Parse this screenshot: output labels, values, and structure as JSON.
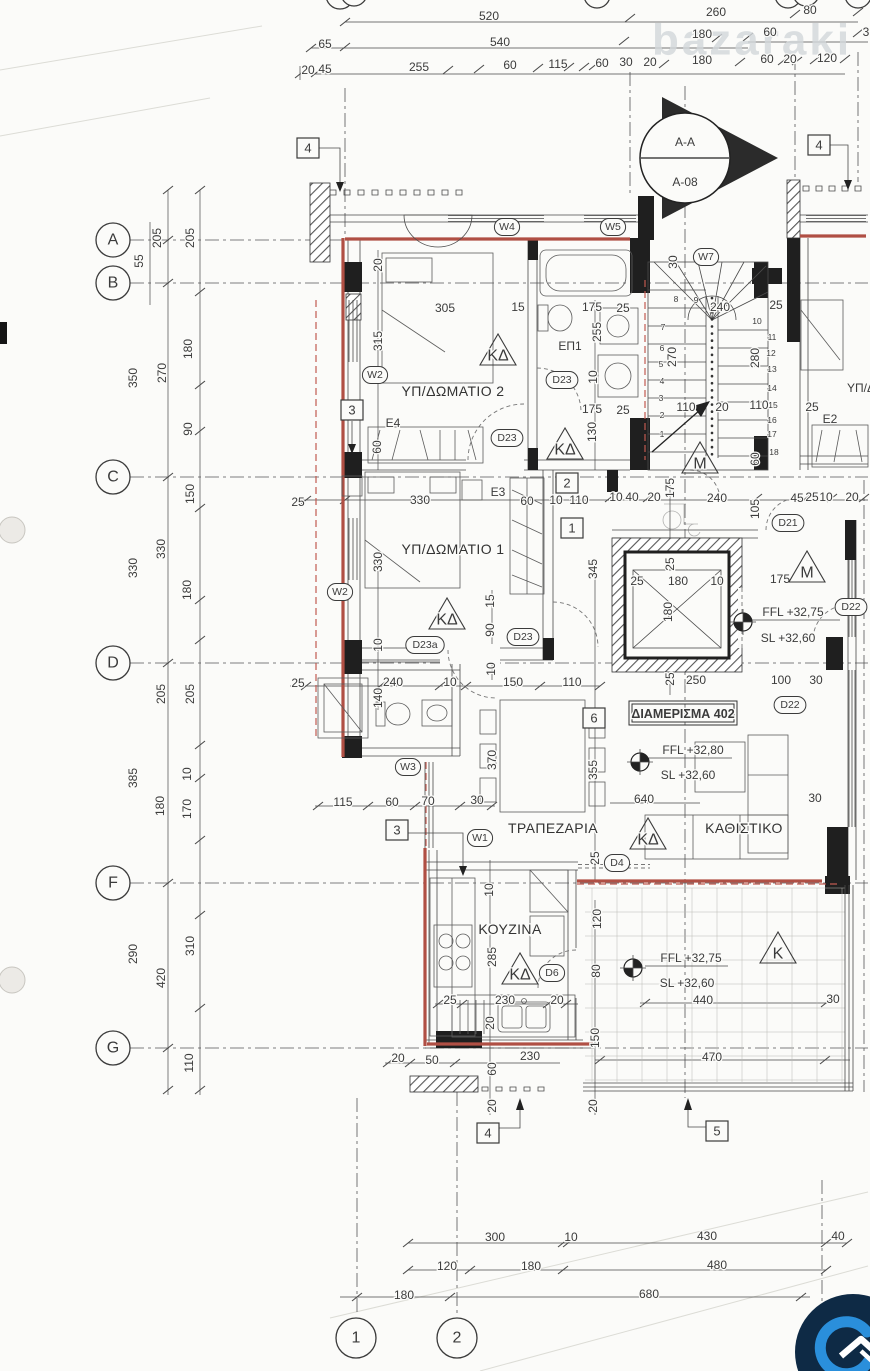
{
  "drawing": {
    "type": "architectural-floor-plan",
    "apartment": "ΔΙΑΜΕΡΙΣΜΑ 402",
    "section_marker": {
      "section": "A-A",
      "sheet": "A-08"
    },
    "rooms": [
      "ΥΠ/ΔΩΜΑΤΙΟ 1",
      "ΥΠ/ΔΩΜΑΤΙΟ 2",
      "ΕΠ1",
      "ΤΡΑΠΕΖΑΡΙΑ",
      "ΚΑΘΙΣΤΙΚΟ",
      "ΚΟΥΖΙΝΑ"
    ],
    "levels": [
      "FFL +32,75",
      "SL +32,60",
      "FFL +32,80"
    ],
    "grid_rows": [
      "A",
      "B",
      "C",
      "D",
      "F",
      "G"
    ],
    "grid_cols": [
      "1",
      "2"
    ],
    "window_tags": [
      "W1",
      "W2",
      "W3",
      "W4",
      "W5",
      "W7"
    ],
    "door_tags": [
      "D4",
      "D6",
      "D21",
      "D22",
      "D23",
      "D23a"
    ],
    "other_tags": [
      "E2",
      "E3",
      "E4",
      "ΚΔ",
      "M",
      "K"
    ],
    "watermark": "bazaraki",
    "colors": {
      "wall_accent_red": "#b04f44",
      "paper": "#fbfbf9",
      "logo_navy": "#0e2a45",
      "logo_blue": "#2a8fdb"
    }
  },
  "annotations": [
    {
      "k": "wm",
      "s": "bazaraki",
      "x": 752,
      "y": 40,
      "f": 44,
      "n": "watermark"
    },
    {
      "k": "t",
      "s": "520",
      "x": 489,
      "y": 16,
      "f": 13
    },
    {
      "k": "t",
      "s": "260",
      "x": 716,
      "y": 12,
      "f": 13
    },
    {
      "k": "t",
      "s": "80",
      "x": 810,
      "y": 10,
      "f": 13
    },
    {
      "k": "t",
      "s": "65",
      "x": 325,
      "y": 44,
      "f": 13
    },
    {
      "k": "t",
      "s": "540",
      "x": 500,
      "y": 42,
      "f": 13
    },
    {
      "k": "t",
      "s": "180",
      "x": 702,
      "y": 34,
      "f": 13
    },
    {
      "k": "t",
      "s": "60",
      "x": 770,
      "y": 32,
      "f": 13
    },
    {
      "k": "t",
      "s": "3",
      "x": 866,
      "y": 32,
      "f": 13
    },
    {
      "k": "t",
      "s": "20",
      "x": 308,
      "y": 70
    },
    {
      "k": "t",
      "s": "45",
      "x": 325,
      "y": 69
    },
    {
      "k": "t",
      "s": "255",
      "x": 419,
      "y": 67,
      "f": 13
    },
    {
      "k": "t",
      "s": "60",
      "x": 510,
      "y": 65,
      "f": 13
    },
    {
      "k": "t",
      "s": "115",
      "x": 558,
      "y": 64,
      "f": 13
    },
    {
      "k": "t",
      "s": "60",
      "x": 602,
      "y": 63,
      "f": 13
    },
    {
      "k": "t",
      "s": "30",
      "x": 626,
      "y": 62,
      "f": 13
    },
    {
      "k": "t",
      "s": "20",
      "x": 650,
      "y": 62,
      "f": 13
    },
    {
      "k": "t",
      "s": "180",
      "x": 702,
      "y": 60,
      "f": 13
    },
    {
      "k": "t",
      "s": "60",
      "x": 767,
      "y": 59,
      "f": 13
    },
    {
      "k": "t",
      "s": "20",
      "x": 790,
      "y": 59,
      "f": 13
    },
    {
      "k": "t",
      "s": "120",
      "x": 827,
      "y": 58,
      "f": 13
    },
    {
      "k": "t",
      "s": "A-A",
      "x": 685,
      "y": 142,
      "f": 17,
      "n": "section-label"
    },
    {
      "k": "t",
      "s": "A-08",
      "x": 685,
      "y": 182,
      "f": 17,
      "n": "section-sheet"
    },
    {
      "k": "box",
      "s": "4",
      "x": 308,
      "y": 148
    },
    {
      "k": "box",
      "s": "4",
      "x": 819,
      "y": 145
    },
    {
      "k": "box",
      "s": "3",
      "x": 352,
      "y": 410
    },
    {
      "k": "box",
      "s": "2",
      "x": 567,
      "y": 483
    },
    {
      "k": "box",
      "s": "1",
      "x": 572,
      "y": 528
    },
    {
      "k": "box",
      "s": "6",
      "x": 594,
      "y": 718
    },
    {
      "k": "box",
      "s": "3",
      "x": 397,
      "y": 830
    },
    {
      "k": "box",
      "s": "4",
      "x": 488,
      "y": 1133
    },
    {
      "k": "box",
      "s": "5",
      "x": 717,
      "y": 1131
    },
    {
      "k": "bub",
      "s": "A",
      "x": 113,
      "y": 240,
      "r": 17,
      "f": 16
    },
    {
      "k": "bub",
      "s": "B",
      "x": 113,
      "y": 283,
      "r": 17,
      "f": 16
    },
    {
      "k": "bub",
      "s": "C",
      "x": 113,
      "y": 477,
      "r": 17,
      "f": 16
    },
    {
      "k": "bub",
      "s": "D",
      "x": 113,
      "y": 663,
      "r": 17,
      "f": 16
    },
    {
      "k": "bub",
      "s": "F",
      "x": 113,
      "y": 883,
      "r": 17,
      "f": 16
    },
    {
      "k": "bub",
      "s": "G",
      "x": 113,
      "y": 1048,
      "r": 17,
      "f": 16
    },
    {
      "k": "bub",
      "s": "1",
      "x": 356,
      "y": 1338,
      "r": 20,
      "f": 19
    },
    {
      "k": "bub",
      "s": "2",
      "x": 457,
      "y": 1338,
      "r": 20,
      "f": 19
    },
    {
      "k": "rt",
      "s": "205",
      "x": 157,
      "y": 238
    },
    {
      "k": "rt",
      "s": "205",
      "x": 190,
      "y": 238
    },
    {
      "k": "rt",
      "s": "55",
      "x": 139,
      "y": 261
    },
    {
      "k": "rt",
      "s": "350",
      "x": 133,
      "y": 378
    },
    {
      "k": "rt",
      "s": "270",
      "x": 162,
      "y": 373
    },
    {
      "k": "rt",
      "s": "180",
      "x": 188,
      "y": 349
    },
    {
      "k": "rt",
      "s": "90",
      "x": 188,
      "y": 429
    },
    {
      "k": "rt",
      "s": "150",
      "x": 190,
      "y": 494
    },
    {
      "k": "rt",
      "s": "330",
      "x": 133,
      "y": 568
    },
    {
      "k": "rt",
      "s": "330",
      "x": 161,
      "y": 549
    },
    {
      "k": "rt",
      "s": "180",
      "x": 187,
      "y": 590
    },
    {
      "k": "rt",
      "s": "205",
      "x": 161,
      "y": 694
    },
    {
      "k": "rt",
      "s": "205",
      "x": 190,
      "y": 694
    },
    {
      "k": "rt",
      "s": "385",
      "x": 133,
      "y": 778
    },
    {
      "k": "rt",
      "s": "10",
      "x": 187,
      "y": 774
    },
    {
      "k": "rt",
      "s": "180",
      "x": 160,
      "y": 806
    },
    {
      "k": "rt",
      "s": "170",
      "x": 187,
      "y": 809
    },
    {
      "k": "rt",
      "s": "290",
      "x": 133,
      "y": 954
    },
    {
      "k": "rt",
      "s": "420",
      "x": 161,
      "y": 978
    },
    {
      "k": "rt",
      "s": "310",
      "x": 190,
      "y": 946
    },
    {
      "k": "rt",
      "s": "110",
      "x": 189,
      "y": 1063
    },
    {
      "k": "rt",
      "s": "20",
      "x": 378,
      "y": 265
    },
    {
      "k": "t",
      "s": "305",
      "x": 445,
      "y": 308
    },
    {
      "k": "t",
      "s": "15",
      "x": 518,
      "y": 307
    },
    {
      "k": "t",
      "s": "175",
      "x": 592,
      "y": 307
    },
    {
      "k": "t",
      "s": "25",
      "x": 623,
      "y": 308
    },
    {
      "k": "rt",
      "s": "315",
      "x": 378,
      "y": 341
    },
    {
      "k": "rt",
      "s": "255",
      "x": 597,
      "y": 332
    },
    {
      "k": "t",
      "s": "ΕΠ1",
      "x": 570,
      "y": 346,
      "f": 13,
      "n": "room-label-ep1"
    },
    {
      "k": "rt",
      "s": "10",
      "x": 593,
      "y": 377
    },
    {
      "k": "room",
      "s": "ΥΠ/ΔΩΜΑΤΙΟ 2",
      "x": 453,
      "y": 391,
      "n": "room-label-bedroom2"
    },
    {
      "k": "t",
      "s": "175",
      "x": 592,
      "y": 409
    },
    {
      "k": "t",
      "s": "25",
      "x": 623,
      "y": 410
    },
    {
      "k": "rt",
      "s": "130",
      "x": 592,
      "y": 432
    },
    {
      "k": "t",
      "s": "E4",
      "x": 393,
      "y": 423
    },
    {
      "k": "rt",
      "s": "60",
      "x": 377,
      "y": 447
    },
    {
      "k": "rt",
      "s": "30",
      "x": 673,
      "y": 262
    },
    {
      "k": "t",
      "s": "240",
      "x": 720,
      "y": 307
    },
    {
      "k": "t",
      "s": "25",
      "x": 776,
      "y": 305
    },
    {
      "k": "rt",
      "s": "270",
      "x": 672,
      "y": 357
    },
    {
      "k": "rt",
      "s": "280",
      "x": 755,
      "y": 358
    },
    {
      "k": "t",
      "s": "110",
      "x": 686,
      "y": 407
    },
    {
      "k": "t",
      "s": "20",
      "x": 722,
      "y": 407
    },
    {
      "k": "t",
      "s": "110",
      "x": 759,
      "y": 405
    },
    {
      "k": "t",
      "s": "25",
      "x": 812,
      "y": 407
    },
    {
      "k": "rt",
      "s": "60",
      "x": 755,
      "y": 459
    },
    {
      "k": "t",
      "s": "E2",
      "x": 830,
      "y": 419,
      "f": 13
    },
    {
      "k": "t",
      "s": "ΥΠ/Δ",
      "x": 861,
      "y": 388,
      "f": 13,
      "n": "room-label-neighbor"
    },
    {
      "k": "sn",
      "s": "1",
      "x": 662,
      "y": 434
    },
    {
      "k": "sn",
      "s": "2",
      "x": 662,
      "y": 415
    },
    {
      "k": "sn",
      "s": "3",
      "x": 661,
      "y": 398
    },
    {
      "k": "sn",
      "s": "4",
      "x": 662,
      "y": 381
    },
    {
      "k": "sn",
      "s": "5",
      "x": 661,
      "y": 364
    },
    {
      "k": "sn",
      "s": "6",
      "x": 662,
      "y": 348
    },
    {
      "k": "sn",
      "s": "7",
      "x": 663,
      "y": 327
    },
    {
      "k": "sn",
      "s": "8",
      "x": 676,
      "y": 299
    },
    {
      "k": "sn",
      "s": "9",
      "x": 696,
      "y": 300
    },
    {
      "k": "sn",
      "s": "10",
      "x": 757,
      "y": 321
    },
    {
      "k": "sn",
      "s": "11",
      "x": 772,
      "y": 337
    },
    {
      "k": "sn",
      "s": "12",
      "x": 771,
      "y": 353
    },
    {
      "k": "sn",
      "s": "13",
      "x": 772,
      "y": 369
    },
    {
      "k": "sn",
      "s": "14",
      "x": 772,
      "y": 388
    },
    {
      "k": "sn",
      "s": "15",
      "x": 773,
      "y": 405
    },
    {
      "k": "sn",
      "s": "16",
      "x": 772,
      "y": 420
    },
    {
      "k": "sn",
      "s": "17",
      "x": 772,
      "y": 434
    },
    {
      "k": "sn",
      "s": "18",
      "x": 774,
      "y": 452
    },
    {
      "k": "t",
      "s": "25",
      "x": 298,
      "y": 502
    },
    {
      "k": "t",
      "s": "330",
      "x": 420,
      "y": 500
    },
    {
      "k": "t",
      "s": "E3",
      "x": 498,
      "y": 492,
      "f": 13
    },
    {
      "k": "t",
      "s": "60",
      "x": 527,
      "y": 501
    },
    {
      "k": "t",
      "s": "10",
      "x": 556,
      "y": 500
    },
    {
      "k": "t",
      "s": "110",
      "x": 579,
      "y": 500
    },
    {
      "k": "t",
      "s": "10",
      "x": 616,
      "y": 497
    },
    {
      "k": "t",
      "s": "40",
      "x": 632,
      "y": 497
    },
    {
      "k": "t",
      "s": "20",
      "x": 654,
      "y": 497
    },
    {
      "k": "t",
      "s": "240",
      "x": 717,
      "y": 498
    },
    {
      "k": "t",
      "s": "45",
      "x": 797,
      "y": 498
    },
    {
      "k": "t",
      "s": "25",
      "x": 812,
      "y": 497
    },
    {
      "k": "t",
      "s": "10",
      "x": 826,
      "y": 497
    },
    {
      "k": "t",
      "s": "20",
      "x": 852,
      "y": 497
    },
    {
      "k": "rt",
      "s": "105",
      "x": 755,
      "y": 509
    },
    {
      "k": "rt",
      "s": "175",
      "x": 670,
      "y": 488
    },
    {
      "k": "rt",
      "s": "330",
      "x": 378,
      "y": 562
    },
    {
      "k": "room",
      "s": "ΥΠ/ΔΩΜΑΤΙΟ 1",
      "x": 453,
      "y": 549,
      "n": "room-label-bedroom1"
    },
    {
      "k": "rt",
      "s": "15",
      "x": 490,
      "y": 601
    },
    {
      "k": "rt",
      "s": "90",
      "x": 490,
      "y": 630
    },
    {
      "k": "rt",
      "s": "345",
      "x": 593,
      "y": 569
    },
    {
      "k": "rt",
      "s": "10",
      "x": 378,
      "y": 645
    },
    {
      "k": "rt",
      "s": "25",
      "x": 670,
      "y": 564
    },
    {
      "k": "t",
      "s": "25",
      "x": 637,
      "y": 581
    },
    {
      "k": "t",
      "s": "180",
      "x": 678,
      "y": 581
    },
    {
      "k": "t",
      "s": "10",
      "x": 717,
      "y": 581
    },
    {
      "k": "rt",
      "s": "180",
      "x": 668,
      "y": 612
    },
    {
      "k": "t",
      "s": "175",
      "x": 780,
      "y": 579
    },
    {
      "k": "lvl",
      "x": 743,
      "y": 622
    },
    {
      "k": "t",
      "s": "FFL +32,75",
      "x": 793,
      "y": 612,
      "f": 13,
      "n": "level-ffl"
    },
    {
      "k": "t",
      "s": "SL +32,60",
      "x": 788,
      "y": 638,
      "f": 13,
      "n": "level-sl"
    },
    {
      "k": "rt",
      "s": "25",
      "x": 670,
      "y": 679
    },
    {
      "k": "t",
      "s": "250",
      "x": 696,
      "y": 680
    },
    {
      "k": "t",
      "s": "100",
      "x": 781,
      "y": 680
    },
    {
      "k": "t",
      "s": "30",
      "x": 816,
      "y": 680
    },
    {
      "k": "apt",
      "s": "ΔΙΑΜΕΡΙΣΜΑ 402",
      "x": 683,
      "y": 714,
      "n": "apartment-label"
    },
    {
      "k": "t",
      "s": "25",
      "x": 298,
      "y": 683
    },
    {
      "k": "t",
      "s": "240",
      "x": 393,
      "y": 682
    },
    {
      "k": "rt",
      "s": "140",
      "x": 378,
      "y": 698
    },
    {
      "k": "t",
      "s": "10",
      "x": 450,
      "y": 682
    },
    {
      "k": "rt",
      "s": "10",
      "x": 491,
      "y": 669
    },
    {
      "k": "t",
      "s": "150",
      "x": 513,
      "y": 682
    },
    {
      "k": "t",
      "s": "110",
      "x": 572,
      "y": 682
    },
    {
      "k": "rt",
      "s": "370",
      "x": 492,
      "y": 760
    },
    {
      "k": "rt",
      "s": "355",
      "x": 593,
      "y": 770
    },
    {
      "k": "lvl",
      "x": 640,
      "y": 762
    },
    {
      "k": "t",
      "s": "FFL +32,80",
      "x": 693,
      "y": 750,
      "f": 13,
      "n": "level-ffl"
    },
    {
      "k": "t",
      "s": "SL +32,60",
      "x": 688,
      "y": 775,
      "f": 13,
      "n": "level-sl"
    },
    {
      "k": "t",
      "s": "640",
      "x": 644,
      "y": 799
    },
    {
      "k": "t",
      "s": "30",
      "x": 815,
      "y": 798
    },
    {
      "k": "t",
      "s": "115",
      "x": 343,
      "y": 802
    },
    {
      "k": "t",
      "s": "60",
      "x": 392,
      "y": 802
    },
    {
      "k": "t",
      "s": "70",
      "x": 428,
      "y": 801
    },
    {
      "k": "t",
      "s": "30",
      "x": 477,
      "y": 800
    },
    {
      "k": "room",
      "s": "ΤΡΑΠΕΖΑΡΙΑ",
      "x": 553,
      "y": 828,
      "n": "room-label-dining"
    },
    {
      "k": "room",
      "s": "ΚΑΘΙΣΤΙΚΟ",
      "x": 744,
      "y": 828,
      "n": "room-label-living"
    },
    {
      "k": "rt",
      "s": "25",
      "x": 595,
      "y": 858
    },
    {
      "k": "rt",
      "s": "10",
      "x": 489,
      "y": 890
    },
    {
      "k": "room",
      "s": "ΚΟΥΖΙΝΑ",
      "x": 510,
      "y": 929,
      "n": "room-label-kitchen"
    },
    {
      "k": "rt",
      "s": "120",
      "x": 597,
      "y": 919
    },
    {
      "k": "rt",
      "s": "285",
      "x": 492,
      "y": 957
    },
    {
      "k": "rt",
      "s": "80",
      "x": 596,
      "y": 971
    },
    {
      "k": "t",
      "s": "25",
      "x": 450,
      "y": 1000
    },
    {
      "k": "t",
      "s": "230",
      "x": 505,
      "y": 1000
    },
    {
      "k": "t",
      "s": "20",
      "x": 557,
      "y": 1000
    },
    {
      "k": "rt",
      "s": "20",
      "x": 490,
      "y": 1023
    },
    {
      "k": "rt",
      "s": "150",
      "x": 595,
      "y": 1038
    },
    {
      "k": "t",
      "s": "20",
      "x": 398,
      "y": 1058
    },
    {
      "k": "t",
      "s": "50",
      "x": 432,
      "y": 1060
    },
    {
      "k": "t",
      "s": "230",
      "x": 530,
      "y": 1056
    },
    {
      "k": "rt",
      "s": "60",
      "x": 492,
      "y": 1069
    },
    {
      "k": "rt",
      "s": "20",
      "x": 492,
      "y": 1106
    },
    {
      "k": "rt",
      "s": "20",
      "x": 593,
      "y": 1106
    },
    {
      "k": "lvl",
      "x": 633,
      "y": 968
    },
    {
      "k": "t",
      "s": "FFL +32,75",
      "x": 691,
      "y": 958,
      "f": 13,
      "n": "level-ffl"
    },
    {
      "k": "t",
      "s": "SL +32,60",
      "x": 687,
      "y": 983,
      "f": 13,
      "n": "level-sl"
    },
    {
      "k": "t",
      "s": "440",
      "x": 703,
      "y": 1000
    },
    {
      "k": "t",
      "s": "470",
      "x": 712,
      "y": 1057
    },
    {
      "k": "t",
      "s": "30",
      "x": 833,
      "y": 999
    },
    {
      "k": "t",
      "s": "300",
      "x": 495,
      "y": 1237,
      "f": 13
    },
    {
      "k": "t",
      "s": "10",
      "x": 571,
      "y": 1237,
      "f": 13
    },
    {
      "k": "t",
      "s": "430",
      "x": 707,
      "y": 1236,
      "f": 13
    },
    {
      "k": "t",
      "s": "40",
      "x": 838,
      "y": 1236,
      "f": 13
    },
    {
      "k": "t",
      "s": "120",
      "x": 447,
      "y": 1266,
      "f": 13
    },
    {
      "k": "t",
      "s": "180",
      "x": 531,
      "y": 1266,
      "f": 13
    },
    {
      "k": "t",
      "s": "480",
      "x": 717,
      "y": 1265,
      "f": 13
    },
    {
      "k": "t",
      "s": "180",
      "x": 404,
      "y": 1295,
      "f": 13
    },
    {
      "k": "t",
      "s": "680",
      "x": 649,
      "y": 1294,
      "f": 13
    },
    {
      "k": "tag",
      "s": "W4",
      "x": 507,
      "y": 227
    },
    {
      "k": "tag",
      "s": "W5",
      "x": 613,
      "y": 227
    },
    {
      "k": "tag",
      "s": "W7",
      "x": 706,
      "y": 257
    },
    {
      "k": "tag",
      "s": "W2",
      "x": 375,
      "y": 375
    },
    {
      "k": "tag",
      "s": "W2",
      "x": 340,
      "y": 592
    },
    {
      "k": "tag",
      "s": "W3",
      "x": 408,
      "y": 767
    },
    {
      "k": "tag",
      "s": "W1",
      "x": 480,
      "y": 838
    },
    {
      "k": "tag",
      "s": "D23",
      "x": 562,
      "y": 380
    },
    {
      "k": "tag",
      "s": "D23",
      "x": 507,
      "y": 438
    },
    {
      "k": "tag",
      "s": "D23",
      "x": 523,
      "y": 637
    },
    {
      "k": "tag",
      "s": "D23a",
      "x": 425,
      "y": 645
    },
    {
      "k": "tag",
      "s": "D21",
      "x": 788,
      "y": 523
    },
    {
      "k": "tag",
      "s": "D22",
      "x": 851,
      "y": 607
    },
    {
      "k": "tag",
      "s": "D22",
      "x": 790,
      "y": 705
    },
    {
      "k": "tag",
      "s": "D4",
      "x": 617,
      "y": 863
    },
    {
      "k": "tag",
      "s": "D6",
      "x": 552,
      "y": 973
    },
    {
      "k": "tri",
      "s": "ΚΔ",
      "x": 498,
      "y": 356
    },
    {
      "k": "tri",
      "s": "ΚΔ",
      "x": 565,
      "y": 450
    },
    {
      "k": "tri",
      "s": "ΚΔ",
      "x": 447,
      "y": 620
    },
    {
      "k": "tri",
      "s": "ΚΔ",
      "x": 648,
      "y": 840
    },
    {
      "k": "tri",
      "s": "ΚΔ",
      "x": 520,
      "y": 975
    },
    {
      "k": "tri",
      "s": "M",
      "x": 700,
      "y": 464
    },
    {
      "k": "tri",
      "s": "M",
      "x": 807,
      "y": 573
    },
    {
      "k": "tri",
      "s": "K",
      "x": 778,
      "y": 954
    }
  ]
}
